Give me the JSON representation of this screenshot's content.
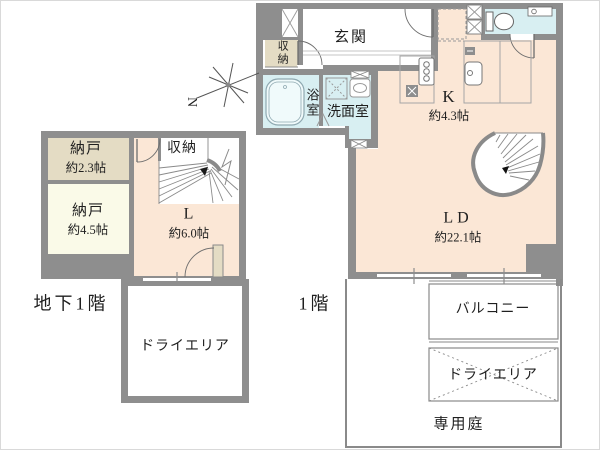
{
  "b1f": {
    "floor_label": "地下1階",
    "rooms": {
      "nando_small": {
        "name": "納戸",
        "size": "約2.3帖"
      },
      "nando_large": {
        "name": "納戸",
        "size": "約4.5帖"
      },
      "closet": {
        "name": "収納"
      },
      "living": {
        "name": "L",
        "size": "約6.0帖"
      },
      "dry_area": {
        "name": "ドライエリア"
      }
    }
  },
  "f1": {
    "floor_label": "1階",
    "rooms": {
      "genkan": {
        "name": "玄関"
      },
      "closet": {
        "name": "収納"
      },
      "bath": {
        "name": "浴室"
      },
      "washroom": {
        "name": "洗面室"
      },
      "kitchen": {
        "name": "K",
        "size": "約4.3帖"
      },
      "living_dining": {
        "name": "LD",
        "size": "約22.1帖"
      },
      "balcony": {
        "name": "バルコニー"
      },
      "dry_area": {
        "name": "ドライエリア"
      },
      "garden": {
        "name": "専用庭"
      }
    }
  },
  "compass": {
    "label": "N"
  },
  "icons": [
    "north-compass-icon",
    "curved-stairs-icon",
    "straight-stairs-icon",
    "bathtub-icon",
    "toilet-icon",
    "stove-icon",
    "kitchen-sink-icon",
    "vanity-sink-icon",
    "washer-space-icon",
    "door-swing-icon",
    "pipe-space-icon",
    "refrigerator-space-icon"
  ],
  "colors": {
    "wall": "#8e8e8e",
    "floor_main": "#fbe7d6",
    "floor_storage": "#e4dcc4",
    "floor_storage_light": "#fafae8",
    "floor_wet": "#d8eff2",
    "line": "#999999",
    "text": "#1f1f1f"
  }
}
